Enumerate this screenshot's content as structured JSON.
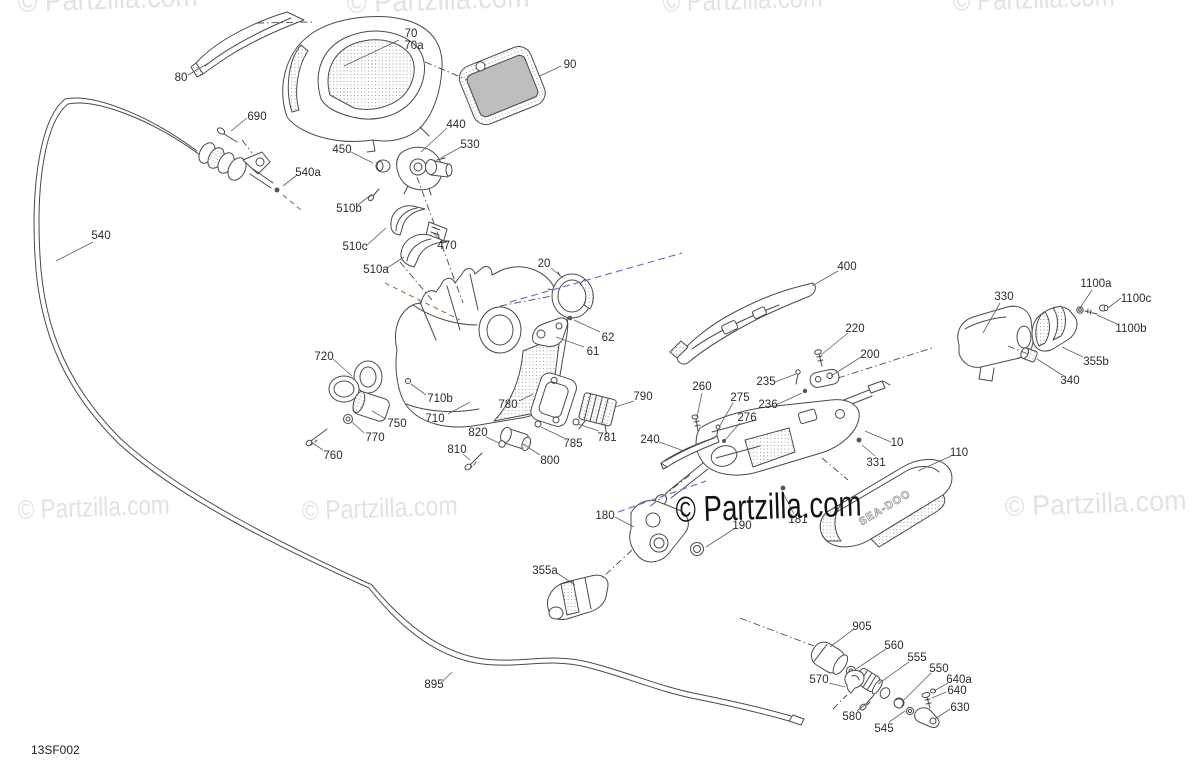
{
  "diagram": {
    "code": "13SF002",
    "watermark": "© Partzilla.com",
    "side_cover_text": "SEA-DOO",
    "colors": {
      "art_line": "#4a4a4a",
      "watermark_light": "#dfe4df",
      "watermark_dark": "#131313",
      "guide_blue": "#7373cf",
      "guide_orange": "#b2693a"
    }
  },
  "watermarks": [
    {
      "x": 18,
      "y": 12,
      "size": 30,
      "w": 180,
      "tone": "light"
    },
    {
      "x": 347,
      "y": 13,
      "size": 30,
      "w": 183,
      "tone": "light"
    },
    {
      "x": 663,
      "y": 12,
      "size": 30,
      "w": 160,
      "tone": "light"
    },
    {
      "x": 953,
      "y": 11,
      "size": 30,
      "w": 162,
      "tone": "light"
    },
    {
      "x": 18,
      "y": 519,
      "size": 27,
      "w": 152,
      "tone": "light"
    },
    {
      "x": 302,
      "y": 520,
      "size": 27,
      "w": 156,
      "tone": "light"
    },
    {
      "x": 1005,
      "y": 516,
      "size": 28,
      "w": 182,
      "tone": "light"
    },
    {
      "x": 676,
      "y": 522,
      "size": 36,
      "w": 186,
      "tone": "dark"
    }
  ],
  "guide_lines": [
    {
      "kind": "align",
      "x1": 257,
      "y1": 23,
      "x2": 312,
      "y2": 22
    },
    {
      "kind": "align",
      "x1": 425,
      "y1": 62,
      "x2": 468,
      "y2": 80
    },
    {
      "kind": "align",
      "x1": 417,
      "y1": 177,
      "x2": 463,
      "y2": 303
    },
    {
      "kind": "align",
      "x1": 400,
      "y1": 262,
      "x2": 432,
      "y2": 300
    },
    {
      "kind": "align",
      "x1": 500,
      "y1": 306,
      "x2": 552,
      "y2": 296
    },
    {
      "kind": "align",
      "x1": 242,
      "y1": 140,
      "x2": 252,
      "y2": 153
    },
    {
      "kind": "align",
      "x1": 822,
      "y1": 458,
      "x2": 848,
      "y2": 480
    },
    {
      "kind": "align",
      "x1": 632,
      "y1": 550,
      "x2": 601,
      "y2": 579
    },
    {
      "kind": "align",
      "x1": 690,
      "y1": 475,
      "x2": 648,
      "y2": 508
    },
    {
      "kind": "align",
      "x1": 740,
      "y1": 618,
      "x2": 814,
      "y2": 646
    },
    {
      "kind": "align",
      "x1": 838,
      "y1": 378,
      "x2": 932,
      "y2": 348
    },
    {
      "kind": "align",
      "x1": 1008,
      "y1": 346,
      "x2": 1028,
      "y2": 354
    },
    {
      "kind": "align",
      "x1": 833,
      "y1": 709,
      "x2": 847,
      "y2": 695
    },
    {
      "kind": "blue",
      "x1": 510,
      "y1": 302,
      "x2": 682,
      "y2": 253
    },
    {
      "kind": "blue",
      "x1": 618,
      "y1": 512,
      "x2": 706,
      "y2": 481
    },
    {
      "kind": "orange",
      "x1": 385,
      "y1": 283,
      "x2": 460,
      "y2": 320
    },
    {
      "kind": "orange",
      "x1": 283,
      "y1": 195,
      "x2": 301,
      "y2": 210
    }
  ],
  "part_labels": [
    {
      "t": "70",
      "x": 411,
      "y": 33,
      "leader": [
        399,
        40,
        344,
        66
      ]
    },
    {
      "t": "70a",
      "x": 414,
      "y": 45
    },
    {
      "t": "80",
      "x": 181,
      "y": 77,
      "leader": [
        188,
        75,
        212,
        61
      ]
    },
    {
      "t": "90",
      "x": 570,
      "y": 64,
      "leader": [
        561,
        66,
        540,
        76
      ]
    },
    {
      "t": "690",
      "x": 257,
      "y": 116,
      "leader": [
        247,
        118,
        231,
        131
      ]
    },
    {
      "t": "440",
      "x": 456,
      "y": 124,
      "leader": [
        447,
        128,
        421,
        152
      ]
    },
    {
      "t": "450",
      "x": 342,
      "y": 149,
      "leader": [
        351,
        152,
        373,
        163
      ]
    },
    {
      "t": "530",
      "x": 470,
      "y": 144,
      "leader": [
        461,
        147,
        441,
        158
      ]
    },
    {
      "t": "540a",
      "x": 308,
      "y": 172,
      "leader": [
        297,
        175,
        283,
        186
      ]
    },
    {
      "t": "510b",
      "x": 349,
      "y": 208,
      "leader": [
        358,
        205,
        372,
        194
      ]
    },
    {
      "t": "510c",
      "x": 355,
      "y": 246,
      "leader": [
        366,
        246,
        386,
        228
      ]
    },
    {
      "t": "470",
      "x": 447,
      "y": 245,
      "leader": [
        440,
        239,
        433,
        233
      ]
    },
    {
      "t": "510a",
      "x": 376,
      "y": 269,
      "leader": [
        387,
        268,
        404,
        257
      ]
    },
    {
      "t": "20",
      "x": 544,
      "y": 263,
      "leader": [
        551,
        268,
        563,
        278
      ]
    },
    {
      "t": "540",
      "x": 101,
      "y": 235,
      "leader": [
        93,
        242,
        56,
        261
      ]
    },
    {
      "t": "400",
      "x": 847,
      "y": 266,
      "leader": [
        838,
        271,
        812,
        286
      ]
    },
    {
      "t": "330",
      "x": 1004,
      "y": 296,
      "leader": [
        1000,
        303,
        983,
        333
      ]
    },
    {
      "t": "1100a",
      "x": 1096,
      "y": 283,
      "leader": [
        1092,
        290,
        1080,
        308
      ]
    },
    {
      "t": "1100c",
      "x": 1136,
      "y": 298,
      "leader": [
        1121,
        298,
        1108,
        308
      ]
    },
    {
      "t": "1100b",
      "x": 1131,
      "y": 328,
      "leader": [
        1117,
        324,
        1097,
        315
      ]
    },
    {
      "t": "355b",
      "x": 1096,
      "y": 361,
      "leader": [
        1083,
        357,
        1062,
        347
      ]
    },
    {
      "t": "340",
      "x": 1070,
      "y": 380,
      "leader": [
        1062,
        375,
        1037,
        359
      ]
    },
    {
      "t": "220",
      "x": 855,
      "y": 328,
      "leader": [
        848,
        333,
        821,
        355
      ]
    },
    {
      "t": "200",
      "x": 870,
      "y": 354,
      "leader": [
        861,
        357,
        831,
        376
      ]
    },
    {
      "t": "235",
      "x": 766,
      "y": 381,
      "leader": [
        775,
        382,
        796,
        374
      ]
    },
    {
      "t": "236",
      "x": 768,
      "y": 404,
      "leader": [
        776,
        405,
        802,
        393
      ]
    },
    {
      "t": "62",
      "x": 608,
      "y": 337,
      "leader": [
        600,
        332,
        574,
        320
      ]
    },
    {
      "t": "61",
      "x": 593,
      "y": 351,
      "leader": [
        584,
        347,
        556,
        337
      ]
    },
    {
      "t": "260",
      "x": 702,
      "y": 386,
      "leader": [
        702,
        393,
        697,
        417
      ]
    },
    {
      "t": "275",
      "x": 740,
      "y": 397,
      "leader": [
        733,
        403,
        719,
        427
      ]
    },
    {
      "t": "276",
      "x": 747,
      "y": 417,
      "leader": [
        740,
        423,
        725,
        440
      ]
    },
    {
      "t": "720",
      "x": 324,
      "y": 356,
      "leader": [
        333,
        359,
        352,
        376
      ]
    },
    {
      "t": "710b",
      "x": 440,
      "y": 398,
      "leader": [
        426,
        395,
        411,
        384
      ]
    },
    {
      "t": "780",
      "x": 508,
      "y": 404,
      "leader": [
        519,
        401,
        533,
        394
      ]
    },
    {
      "t": "790",
      "x": 643,
      "y": 396,
      "leader": [
        634,
        401,
        615,
        407
      ]
    },
    {
      "t": "750",
      "x": 397,
      "y": 423,
      "leader": [
        386,
        419,
        372,
        411
      ]
    },
    {
      "t": "710",
      "x": 435,
      "y": 418,
      "leader": [
        448,
        414,
        470,
        402
      ]
    },
    {
      "t": "770",
      "x": 375,
      "y": 437,
      "leader": [
        364,
        433,
        351,
        421
      ]
    },
    {
      "t": "820",
      "x": 478,
      "y": 432,
      "leader": [
        486,
        437,
        499,
        443
      ]
    },
    {
      "t": "785",
      "x": 573,
      "y": 443,
      "leader": [
        564,
        438,
        541,
        427
      ]
    },
    {
      "t": "781",
      "x": 607,
      "y": 437,
      "leader": [
        599,
        431,
        578,
        424
      ]
    },
    {
      "t": "240",
      "x": 650,
      "y": 439,
      "leader": [
        659,
        442,
        684,
        451
      ]
    },
    {
      "t": "10",
      "x": 897,
      "y": 442,
      "leader": [
        891,
        442,
        865,
        431
      ]
    },
    {
      "t": "760",
      "x": 333,
      "y": 455,
      "leader": [
        323,
        450,
        311,
        442
      ]
    },
    {
      "t": "810",
      "x": 457,
      "y": 449,
      "leader": [
        463,
        454,
        470,
        460
      ]
    },
    {
      "t": "800",
      "x": 550,
      "y": 460,
      "leader": [
        540,
        455,
        523,
        444
      ]
    },
    {
      "t": "331",
      "x": 876,
      "y": 462,
      "leader": [
        875,
        456,
        862,
        445
      ]
    },
    {
      "t": "110",
      "x": 959,
      "y": 452,
      "leader": [
        951,
        456,
        918,
        471
      ]
    },
    {
      "t": "180",
      "x": 605,
      "y": 515,
      "leader": [
        615,
        517,
        634,
        527
      ]
    },
    {
      "t": "190",
      "x": 742,
      "y": 525,
      "leader": [
        734,
        529,
        706,
        547
      ]
    },
    {
      "t": "181",
      "x": 798,
      "y": 519,
      "leader": [
        794,
        514,
        782,
        491
      ]
    },
    {
      "t": "355a",
      "x": 545,
      "y": 570,
      "leader": [
        557,
        573,
        575,
        585
      ]
    },
    {
      "t": "905",
      "x": 862,
      "y": 626,
      "leader": [
        854,
        629,
        830,
        647
      ]
    },
    {
      "t": "560",
      "x": 894,
      "y": 645,
      "leader": [
        886,
        649,
        856,
        669
      ]
    },
    {
      "t": "555",
      "x": 917,
      "y": 657,
      "leader": [
        909,
        662,
        878,
        684
      ]
    },
    {
      "t": "550",
      "x": 939,
      "y": 668,
      "leader": [
        931,
        673,
        903,
        701
      ]
    },
    {
      "t": "640a",
      "x": 959,
      "y": 679,
      "leader": [
        948,
        683,
        934,
        691
      ]
    },
    {
      "t": "640",
      "x": 957,
      "y": 690,
      "leader": [
        946,
        692,
        932,
        698
      ]
    },
    {
      "t": "630",
      "x": 960,
      "y": 707,
      "leader": [
        950,
        709,
        935,
        719
      ]
    },
    {
      "t": "570",
      "x": 819,
      "y": 679,
      "leader": [
        829,
        683,
        845,
        687
      ]
    },
    {
      "t": "580",
      "x": 852,
      "y": 716,
      "leader": [
        857,
        711,
        866,
        704
      ]
    },
    {
      "t": "545",
      "x": 884,
      "y": 728,
      "leader": [
        889,
        722,
        905,
        711
      ]
    },
    {
      "t": "895",
      "x": 434,
      "y": 684,
      "leader": [
        441,
        683,
        452,
        672
      ]
    }
  ]
}
